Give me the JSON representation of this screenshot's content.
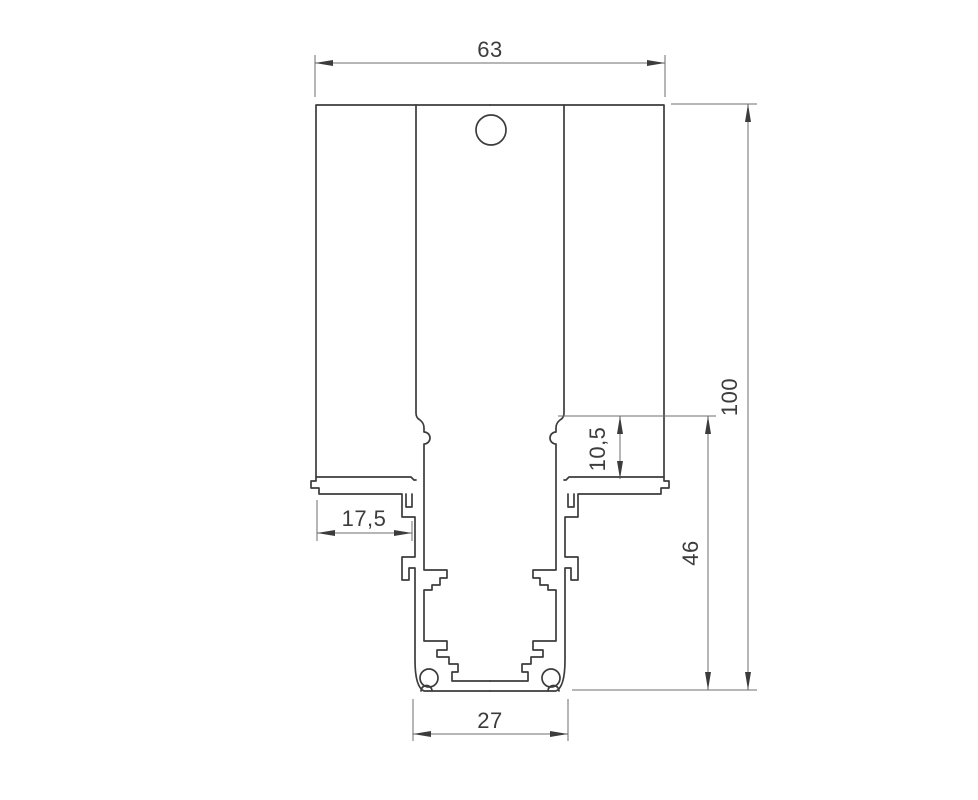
{
  "drawing": {
    "kind": "profile-cross-section",
    "labels": {
      "top_width": "63",
      "overall_height": "100",
      "track_height": "46",
      "pocket_depth": "10,5",
      "wing_inner_width": "17,5",
      "track_width": "27"
    },
    "colors": {
      "background": "#ffffff",
      "object_line": "#3c3c3c",
      "dimension_line": "#6d6d6d",
      "text": "#3c3c3c"
    }
  }
}
